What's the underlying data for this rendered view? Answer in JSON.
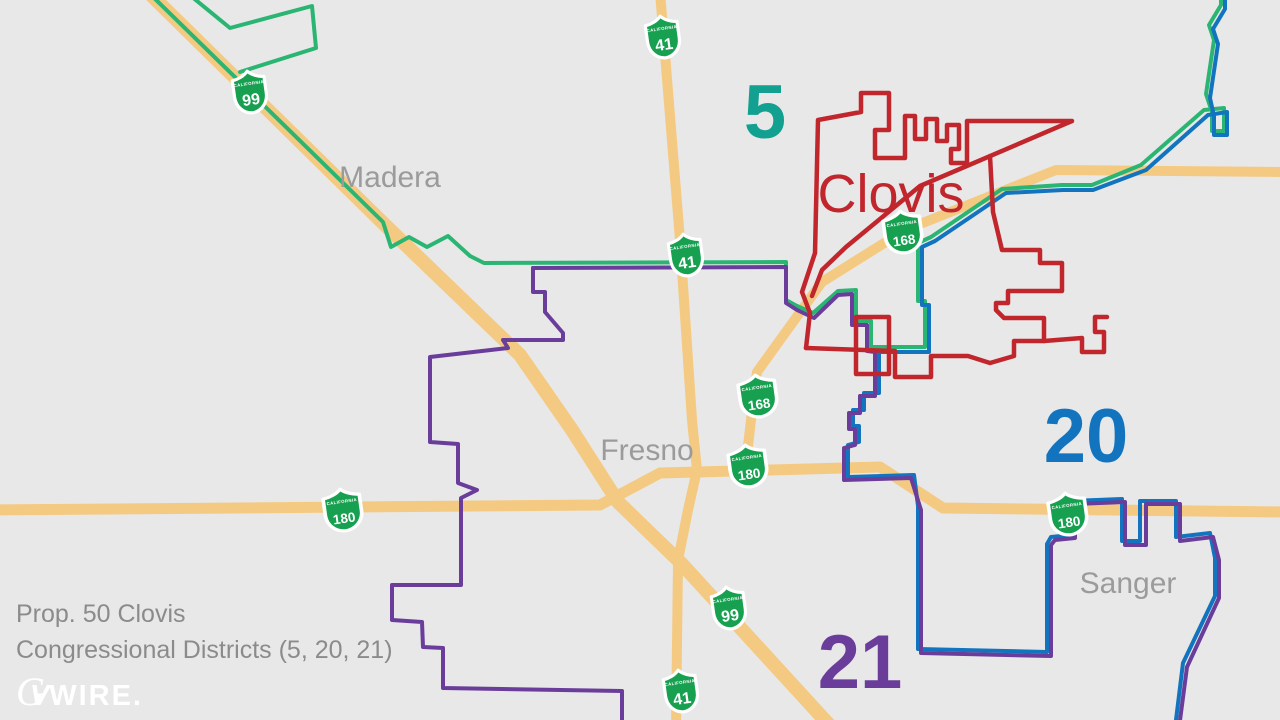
{
  "caption": {
    "line1": "Prop. 50 Clovis",
    "line2": "Congressional Districts (5, 20, 21)"
  },
  "logo": {
    "g": "G",
    "v": "V",
    "rest": "WIRE."
  },
  "map": {
    "background": "#e8e8e8",
    "colors": {
      "road": "#f4ca82",
      "district5_line": "#2bb573",
      "district20_line": "#1273bf",
      "district21_line": "#6a3d9b",
      "city_boundary": "#c1262d",
      "shield_green": "#16a050",
      "shield_text": "#ffffff",
      "city_label": "#9b9b9b",
      "clovis_label": "#c1262d",
      "district5_label": "#12a091",
      "district20_label": "#1273bf",
      "district21_label": "#6a3d9b"
    },
    "shield_state_text": "CALIFORNIA",
    "roads": [
      {
        "name": "route-99",
        "width": 14,
        "points": [
          [
            148,
            -8
          ],
          [
            385,
            225
          ],
          [
            520,
            355
          ],
          [
            572,
            430
          ],
          [
            618,
            502
          ],
          [
            680,
            562
          ],
          [
            832,
            728
          ]
        ]
      },
      {
        "name": "route-41",
        "width": 10,
        "points": [
          [
            660,
            -8
          ],
          [
            680,
            240
          ],
          [
            692,
            420
          ],
          [
            697,
            470
          ],
          [
            688,
            510
          ],
          [
            678,
            560
          ],
          [
            676,
            728
          ]
        ]
      },
      {
        "name": "route-168",
        "width": 10,
        "points": [
          [
            1286,
            172
          ],
          [
            1056,
            170
          ],
          [
            905,
            230
          ],
          [
            822,
            282
          ],
          [
            780,
            340
          ],
          [
            757,
            372
          ],
          [
            751,
            420
          ],
          [
            745,
            472
          ]
        ]
      },
      {
        "name": "route-180",
        "width": 11,
        "points": [
          [
            -8,
            510
          ],
          [
            600,
            505
          ],
          [
            660,
            473
          ],
          [
            880,
            467
          ],
          [
            943,
            508
          ],
          [
            1286,
            512
          ]
        ]
      }
    ],
    "boundaries": [
      {
        "name": "district5-main",
        "color": "district5_line",
        "width": 4,
        "points": [
          [
            148,
            -8
          ],
          [
            383,
            222
          ],
          [
            391,
            247
          ],
          [
            409,
            237
          ],
          [
            427,
            247
          ],
          [
            448,
            236
          ],
          [
            470,
            256
          ],
          [
            484,
            263
          ],
          [
            786,
            262
          ],
          [
            786,
            300
          ],
          [
            797,
            306
          ],
          [
            813,
            313
          ],
          [
            838,
            291
          ],
          [
            856,
            290
          ],
          [
            856,
            321
          ],
          [
            871,
            321
          ],
          [
            871,
            347
          ],
          [
            925,
            347
          ],
          [
            925,
            301
          ],
          [
            918,
            301
          ],
          [
            918,
            243
          ],
          [
            931,
            237
          ],
          [
            1002,
            189
          ],
          [
            1062,
            185
          ],
          [
            1092,
            185
          ],
          [
            1141,
            165
          ],
          [
            1204,
            110
          ],
          [
            1224,
            108
          ],
          [
            1224,
            131
          ],
          [
            1212,
            131
          ],
          [
            1212,
            112
          ],
          [
            1206,
            94
          ],
          [
            1214,
            40
          ],
          [
            1209,
            25
          ],
          [
            1221,
            5
          ],
          [
            1221,
            -8
          ]
        ]
      },
      {
        "name": "district5-zigzag",
        "color": "district5_line",
        "width": 4,
        "points": [
          [
            186,
            -8
          ],
          [
            230,
            28
          ],
          [
            312,
            6
          ],
          [
            316,
            48
          ],
          [
            240,
            72
          ]
        ]
      },
      {
        "name": "district20-main",
        "color": "district20_line",
        "width": 4,
        "points": [
          [
            1225,
            -8
          ],
          [
            1225,
            9
          ],
          [
            1213,
            29
          ],
          [
            1218,
            44
          ],
          [
            1210,
            98
          ],
          [
            1214,
            116
          ],
          [
            1214,
            135
          ],
          [
            1227,
            135
          ],
          [
            1227,
            112
          ],
          [
            1208,
            115
          ],
          [
            1146,
            170
          ],
          [
            1093,
            190
          ],
          [
            1063,
            190
          ],
          [
            1006,
            193
          ],
          [
            935,
            241
          ],
          [
            922,
            247
          ],
          [
            922,
            305
          ],
          [
            929,
            305
          ],
          [
            929,
            352
          ],
          [
            879,
            352
          ],
          [
            879,
            393
          ],
          [
            864,
            393
          ],
          [
            864,
            410
          ],
          [
            853,
            410
          ],
          [
            853,
            426
          ],
          [
            859,
            426
          ],
          [
            859,
            442
          ],
          [
            848,
            445
          ],
          [
            848,
            477
          ],
          [
            914,
            475
          ],
          [
            918,
            506
          ],
          [
            918,
            649
          ],
          [
            1047,
            652
          ],
          [
            1047,
            544
          ],
          [
            1051,
            537
          ],
          [
            1071,
            535
          ],
          [
            1071,
            501
          ],
          [
            1122,
            499
          ],
          [
            1122,
            541
          ],
          [
            1140,
            541
          ],
          [
            1140,
            501
          ],
          [
            1176,
            501
          ],
          [
            1176,
            537
          ],
          [
            1210,
            533
          ],
          [
            1215,
            558
          ],
          [
            1215,
            596
          ],
          [
            1183,
            663
          ],
          [
            1175,
            728
          ]
        ]
      },
      {
        "name": "district21-east",
        "color": "district21_line",
        "width": 4,
        "points": [
          [
            533,
            268
          ],
          [
            786,
            267
          ],
          [
            786,
            303
          ],
          [
            797,
            310
          ],
          [
            814,
            318
          ],
          [
            838,
            295
          ],
          [
            852,
            294
          ],
          [
            852,
            325
          ],
          [
            867,
            325
          ],
          [
            867,
            351
          ],
          [
            875,
            352
          ],
          [
            875,
            396
          ],
          [
            860,
            396
          ],
          [
            860,
            413
          ],
          [
            849,
            413
          ],
          [
            849,
            429
          ],
          [
            855,
            429
          ],
          [
            855,
            445
          ],
          [
            844,
            448
          ],
          [
            844,
            480
          ],
          [
            911,
            478
          ],
          [
            921,
            510
          ],
          [
            921,
            653
          ],
          [
            1051,
            656
          ],
          [
            1051,
            545
          ],
          [
            1055,
            540
          ],
          [
            1075,
            538
          ],
          [
            1075,
            504
          ],
          [
            1125,
            502
          ],
          [
            1125,
            545
          ],
          [
            1146,
            545
          ],
          [
            1146,
            504
          ],
          [
            1180,
            504
          ],
          [
            1180,
            541
          ],
          [
            1213,
            537
          ],
          [
            1219,
            560
          ],
          [
            1219,
            598
          ],
          [
            1187,
            667
          ],
          [
            1179,
            728
          ]
        ]
      },
      {
        "name": "district21-west",
        "color": "district21_line",
        "width": 4,
        "points": [
          [
            533,
            268
          ],
          [
            533,
            292
          ],
          [
            545,
            292
          ],
          [
            545,
            312
          ],
          [
            563,
            333
          ],
          [
            563,
            340
          ],
          [
            503,
            340
          ],
          [
            508,
            348
          ],
          [
            430,
            357
          ],
          [
            430,
            442
          ],
          [
            458,
            444
          ],
          [
            458,
            483
          ],
          [
            477,
            490
          ],
          [
            461,
            498
          ],
          [
            461,
            585
          ],
          [
            392,
            585
          ],
          [
            392,
            620
          ],
          [
            422,
            622
          ],
          [
            423,
            647
          ],
          [
            443,
            648
          ],
          [
            443,
            688
          ],
          [
            622,
            691
          ],
          [
            622,
            728
          ]
        ]
      },
      {
        "name": "clovis-boundary-west-north",
        "color": "city_boundary",
        "width": 4.5,
        "points": [
          [
            806,
            348
          ],
          [
            810,
            313
          ],
          [
            802,
            292
          ],
          [
            815,
            253
          ],
          [
            818,
            120
          ],
          [
            861,
            112
          ],
          [
            861,
            93
          ],
          [
            889,
            93
          ],
          [
            889,
            130
          ],
          [
            875,
            130
          ],
          [
            875,
            158
          ],
          [
            905,
            158
          ],
          [
            905,
            116
          ],
          [
            915,
            116
          ],
          [
            915,
            139
          ],
          [
            926,
            139
          ],
          [
            926,
            119
          ],
          [
            937,
            119
          ],
          [
            937,
            141
          ],
          [
            947,
            141
          ],
          [
            947,
            125
          ],
          [
            959,
            125
          ],
          [
            959,
            149
          ],
          [
            951,
            149
          ],
          [
            951,
            163
          ],
          [
            967,
            163
          ],
          [
            967,
            121
          ],
          [
            1072,
            121
          ],
          [
            920,
            186
          ],
          [
            846,
            247
          ],
          [
            822,
            270
          ],
          [
            812,
            296
          ]
        ]
      },
      {
        "name": "clovis-boundary-east-south",
        "color": "city_boundary",
        "width": 4.5,
        "points": [
          [
            990,
            156
          ],
          [
            993,
            212
          ],
          [
            1002,
            250
          ],
          [
            1040,
            250
          ],
          [
            1040,
            263
          ],
          [
            1062,
            263
          ],
          [
            1062,
            291
          ],
          [
            1008,
            291
          ],
          [
            1008,
            303
          ],
          [
            996,
            303
          ],
          [
            996,
            310
          ],
          [
            1004,
            318
          ],
          [
            1044,
            318
          ],
          [
            1044,
            341
          ],
          [
            1014,
            341
          ],
          [
            1014,
            356
          ],
          [
            990,
            363
          ],
          [
            968,
            356
          ],
          [
            931,
            356
          ],
          [
            931,
            377
          ],
          [
            895,
            377
          ],
          [
            895,
            351
          ],
          [
            806,
            348
          ]
        ]
      },
      {
        "name": "clovis-boundary-box",
        "color": "city_boundary",
        "width": 4.5,
        "points": [
          [
            856,
            317
          ],
          [
            889,
            317
          ],
          [
            889,
            374
          ],
          [
            856,
            374
          ],
          [
            856,
            317
          ]
        ]
      },
      {
        "name": "clovis-boundary-stub",
        "color": "city_boundary",
        "width": 4.5,
        "points": [
          [
            1044,
            341
          ],
          [
            1082,
            338
          ],
          [
            1082,
            352
          ],
          [
            1104,
            352
          ],
          [
            1104,
            332
          ],
          [
            1095,
            332
          ],
          [
            1095,
            317
          ],
          [
            1107,
            317
          ]
        ]
      }
    ],
    "shields": [
      {
        "route": "41",
        "x": 663,
        "y": 37
      },
      {
        "route": "99",
        "x": 250,
        "y": 92
      },
      {
        "route": "41",
        "x": 686,
        "y": 255
      },
      {
        "route": "168",
        "x": 903,
        "y": 232
      },
      {
        "route": "168",
        "x": 758,
        "y": 396
      },
      {
        "route": "180",
        "x": 748,
        "y": 466
      },
      {
        "route": "180",
        "x": 343,
        "y": 510
      },
      {
        "route": "180",
        "x": 1068,
        "y": 514
      },
      {
        "route": "99",
        "x": 729,
        "y": 608
      },
      {
        "route": "41",
        "x": 681,
        "y": 691
      }
    ],
    "city_labels": [
      {
        "name": "madera",
        "text": "Madera",
        "x": 390,
        "y": 187,
        "size": 30,
        "color": "city_label",
        "weight": "normal"
      },
      {
        "name": "fresno",
        "text": "Fresno",
        "x": 647,
        "y": 460,
        "size": 30,
        "color": "city_label",
        "weight": "normal"
      },
      {
        "name": "sanger",
        "text": "Sanger",
        "x": 1128,
        "y": 593,
        "size": 30,
        "color": "city_label",
        "weight": "normal"
      },
      {
        "name": "clovis",
        "text": "Clovis",
        "x": 891,
        "y": 212,
        "size": 54,
        "color": "clovis_label",
        "weight": "500"
      }
    ],
    "district_labels": [
      {
        "name": "district-5",
        "text": "5",
        "x": 765,
        "y": 138,
        "color": "district5_label"
      },
      {
        "name": "district-20",
        "text": "20",
        "x": 1086,
        "y": 462,
        "color": "district20_label"
      },
      {
        "name": "district-21",
        "text": "21",
        "x": 860,
        "y": 688,
        "color": "district21_label"
      }
    ]
  }
}
